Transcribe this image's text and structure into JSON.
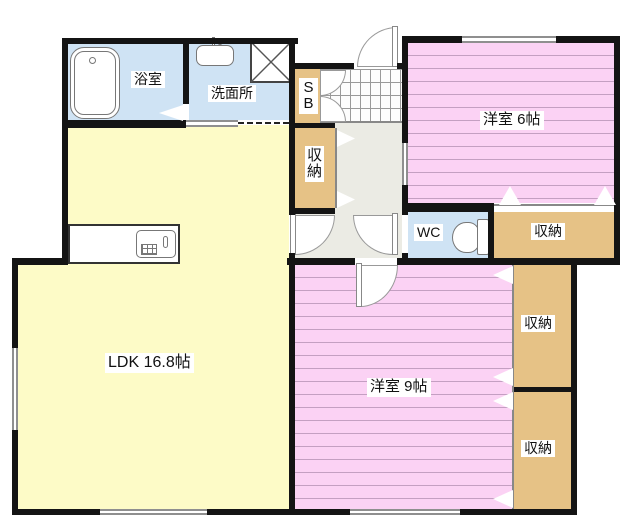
{
  "plan": {
    "labels": {
      "bathroom": "浴室",
      "washroom": "洗面所",
      "shoe_box": "SB",
      "hall_closet": "収納",
      "bedroom6": "洋室 6帖",
      "wc": "WC",
      "wc_closet": "収納",
      "ldk": "LDK 16.8帖",
      "bedroom9": "洋室 9帖",
      "bedroom9_closet_upper": "収納",
      "bedroom9_closet_lower": "収納"
    },
    "icons": {
      "bathtub": "bathtub-icon",
      "sink": "sink-icon",
      "washing_machine": "washing-machine-icon",
      "toilet": "toilet-icon",
      "kitchen_counter": "kitchen-counter-icon",
      "entrance_tile": "entrance-tile-pattern",
      "door_swing": "door-swing-arc",
      "folding_door": "folding-door-marker",
      "window": "window-marker"
    },
    "colors": {
      "wall": "#141414",
      "pink": "#fbd2f4",
      "pink_stripe": "#c49fc2",
      "yellow": "#fdfbc7",
      "blue": "#cfe3f4",
      "tan": "#e6c286",
      "hall": "#ebebe4",
      "window": "#8f8f8f"
    }
  }
}
